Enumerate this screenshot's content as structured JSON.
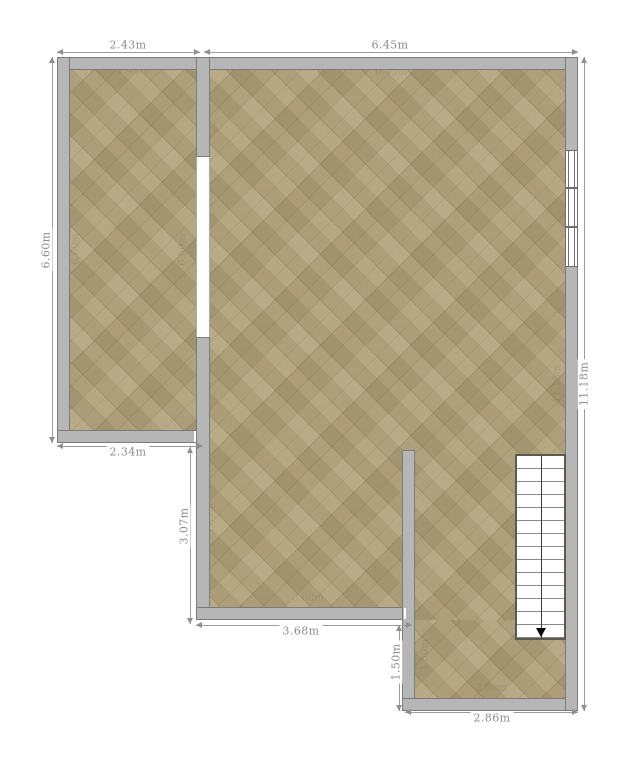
{
  "plan": {
    "type": "residential-floor-plan"
  },
  "dimensions": [
    {
      "id": "top-left-width",
      "label": "2.43m"
    },
    {
      "id": "top-right-width",
      "label": "6.45m"
    },
    {
      "id": "left-height",
      "label": "6.60m"
    },
    {
      "id": "right-height",
      "label": "11.18m"
    },
    {
      "id": "left-room-bottom-width",
      "label": "2.34m"
    },
    {
      "id": "mid-left-height",
      "label": "3.07m"
    },
    {
      "id": "bottom-middle-width",
      "label": "3.68m"
    },
    {
      "id": "lower-notch-height",
      "label": "1.50m"
    },
    {
      "id": "bottom-right-width",
      "label": "2.86m"
    }
  ],
  "faint_labels": [
    {
      "text": "2.43m"
    },
    {
      "text": "6.45m"
    },
    {
      "text": "6.60m"
    },
    {
      "text": "6.60m"
    },
    {
      "text": "3.07m"
    },
    {
      "text": "3.68m"
    },
    {
      "text": "1.50m"
    },
    {
      "text": "2.86m"
    },
    {
      "text": "11.18m"
    }
  ],
  "stairs": {
    "treads": 14,
    "direction": "down"
  },
  "window": {
    "panes": 3
  },
  "colors": {
    "wall": "#b6b6b6",
    "wall_outline": "#7b7b7b",
    "floor": "#b1a17b",
    "dimension_text": "#8c8c8c",
    "stairs_border": "#5e594f",
    "background": "#ffffff"
  }
}
